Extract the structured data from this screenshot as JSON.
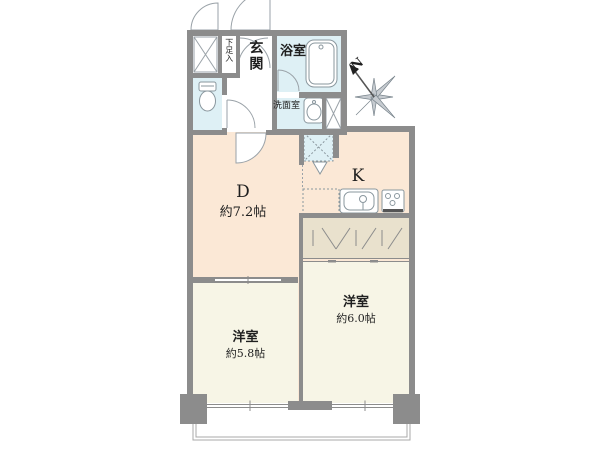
{
  "floor_plan": {
    "rooms": {
      "entrance": {
        "label": "玄関"
      },
      "bathroom": {
        "label": "浴室"
      },
      "washroom": {
        "label": "洗面室"
      },
      "shoe_storage": {
        "label": "下足入"
      },
      "dining": {
        "label": "D",
        "size": "約7.2帖"
      },
      "kitchen": {
        "label": "K"
      },
      "western_room_right": {
        "label": "洋室",
        "size": "約6.0帖"
      },
      "western_room_left": {
        "label": "洋室",
        "size": "約5.8帖"
      }
    },
    "compass": {
      "label": "N"
    },
    "fixtures": [
      "bathtub",
      "toilet",
      "wash-basin",
      "kitchen-sink",
      "gas-stove",
      "washing-machine-space",
      "refrigerator-space",
      "pipe-space",
      "closet-hatched",
      "balcony",
      "pillar",
      "door-swing"
    ],
    "colors": {
      "wall": "#8c8c8c",
      "dining_kitchen_floor": "#fbe8d6",
      "western_room_floor": "#f7f5e6",
      "wet_area_floor": "#def0f5",
      "closet_floor": "#e9e1cd",
      "fixture_line": "#8a979e",
      "outline": "#9aa2a8"
    }
  }
}
